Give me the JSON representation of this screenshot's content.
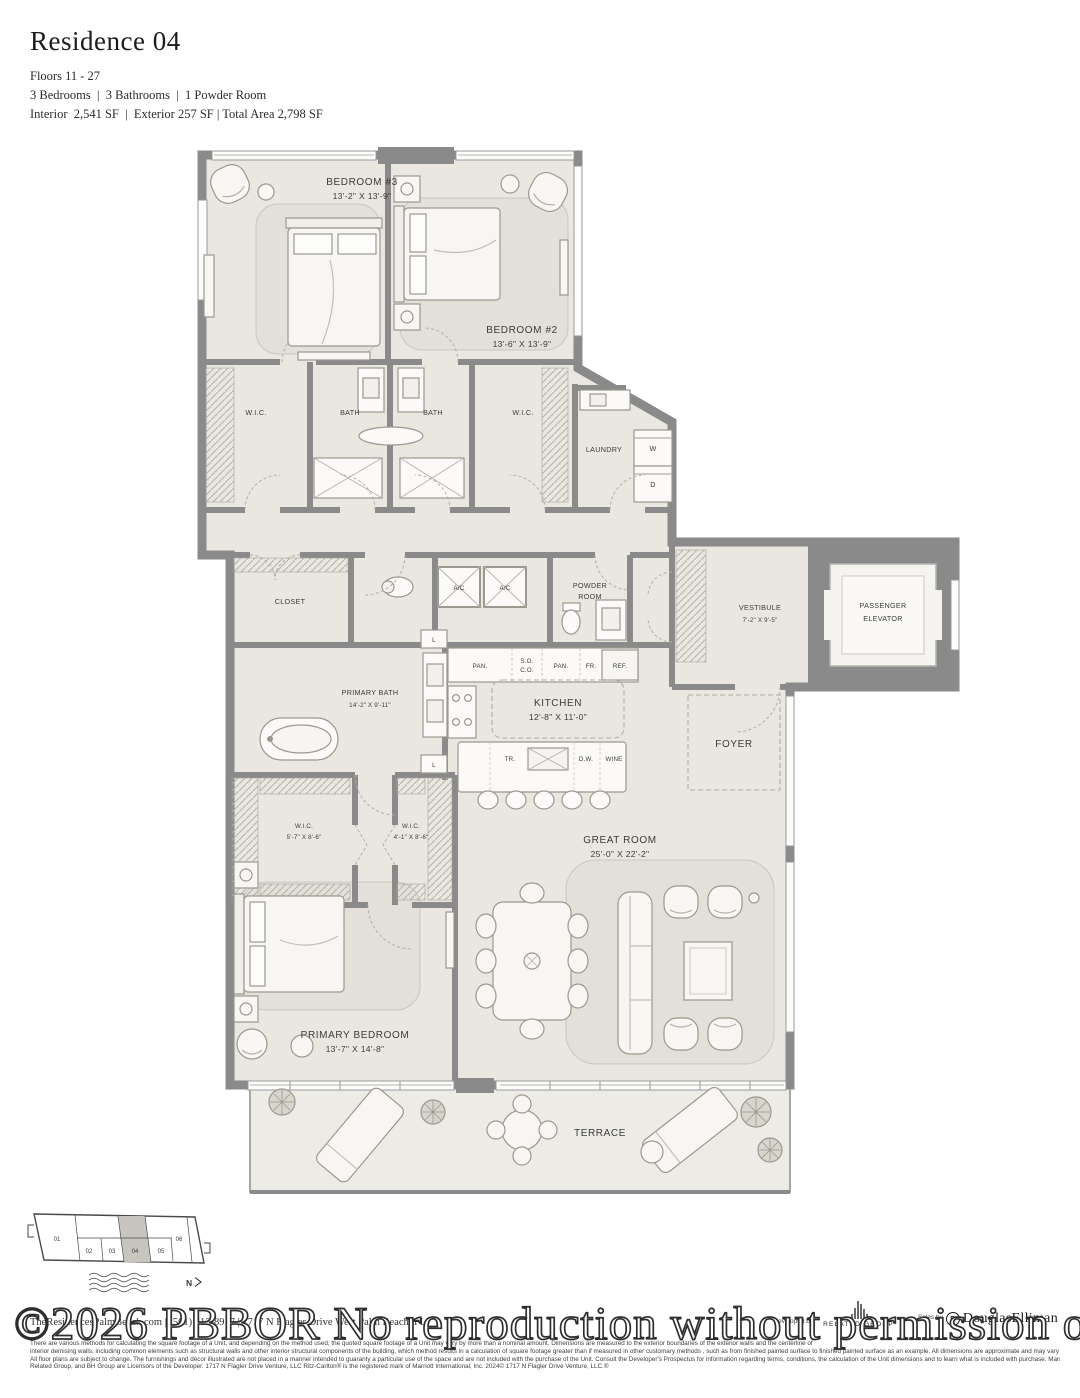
{
  "header": {
    "title": "Residence 04",
    "floors": "Floors 11 - 27",
    "rooms_line": "3 Bedrooms  |  3 Bathrooms  |  1 Powder Room",
    "area_line": "Interior  2,541 SF  |  Exterior 257 SF | Total Area 2,798 SF"
  },
  "plan": {
    "bedroom3_name": "BEDROOM #3",
    "bedroom3_dims": "13'-2\" X 13'-9\"",
    "bedroom2_name": "BEDROOM #2",
    "bedroom2_dims": "13'-6\" X 13'-9\"",
    "wic": "W.I.C.",
    "wic2": "W.I.C.",
    "bath1": "BATH",
    "bath2": "BATH",
    "laundry": "LAUNDRY",
    "washer": "W",
    "dryer": "D",
    "closet": "CLOSET",
    "ac1": "A/C",
    "ac2": "A/C",
    "powder1": "POWDER",
    "powder2": "ROOM",
    "vestibule_name": "VESTIBULE",
    "vestibule_dims": "7'-2\" X 9'-5\"",
    "elevator1": "PASSENGER",
    "elevator2": "ELEVATOR",
    "pbath_name": "PRIMARY BATH",
    "pbath_dims": "14'-2\" X 9'-11\"",
    "linen1": "L",
    "linen2": "L",
    "pan1": "PAN.",
    "so": "S.O.",
    "co": "C.O.",
    "pan2": "PAN.",
    "fr": "FR.",
    "ref": "REF.",
    "kitchen_name": "KITCHEN",
    "kitchen_dims": "12'-8\" X 11'-0\"",
    "tr": "TR.",
    "dw": "D.W.",
    "wine": "WINE",
    "foyer": "FOYER",
    "pwic1_name": "W.I.C.",
    "pwic1_dims": "5'-7\" X 8'-6\"",
    "pwic2_name": "W.I.C.",
    "pwic2_dims": "4'-1\" X 8'-6\"",
    "great_name": "GREAT ROOM",
    "great_dims": "25'-0\" X 22'-2\"",
    "pbed_name": "PRIMARY BEDROOM",
    "pbed_dims": "13'-7\" X 14'-8\"",
    "terrace": "TERRACE"
  },
  "keyplan": {
    "u1": "01",
    "u2": "02",
    "u3": "03",
    "u4": "04",
    "u5": "05",
    "u6": "06",
    "north": "N"
  },
  "watermark": "©2026 PBBOR No reproduction without permission of Listing B",
  "footer": {
    "contact": "TheResidencesPalmBeach.com  |  (561) 212-8917  |  1717 N Flagler Drive West Palm Beach, FL",
    "legal1": "There are various methods for calculating the square footage of a Unit, and depending on the method used, the quoted square footage of a Unit may vary by more than a nominal amount. Dimensions are measured to the exterior boundaries of the exterior walls and the centerline of",
    "legal2": "interior demising walls, including common elements such as structural walls and other interior structural components of the building, which method results in a calculation of square footage greater than if measured in other customary methods , such as from finished painted surface to finished painted surface as an example. All dimensions are approximate and may vary with actual construction.",
    "legal3": "All floor plans are subject to change.  The furnishings and décor illustrated are not placed in a manner intended to guaranty a particular use of the space and are not included with the purchase of the Unit.  Consult the Developer's Prospectus for information regarding terms, conditions, the calculation of the Unit dimensions and to learn what is included with purchase. Marriott International, Inc. The",
    "legal4": "Related Group, and BH Group are Licensors of the Developer. 1717 N Flagler Drive Venture, LLC Ritz-Carlton® is the registered mark of Marriott International, Inc. 2024© 1717 N Flagler Drive Venture, LLC.®",
    "developed_by": "Developed by",
    "related": "RELATED GROUP",
    "sales_by": "Sales by",
    "elliman_mark": "D",
    "elliman": "DouglasElliman"
  },
  "colors": {
    "wall": "#8a8a8a",
    "floor": "#eae7e1",
    "rug": "#e3e0d9",
    "highlight_unit": "#c8c5be"
  }
}
